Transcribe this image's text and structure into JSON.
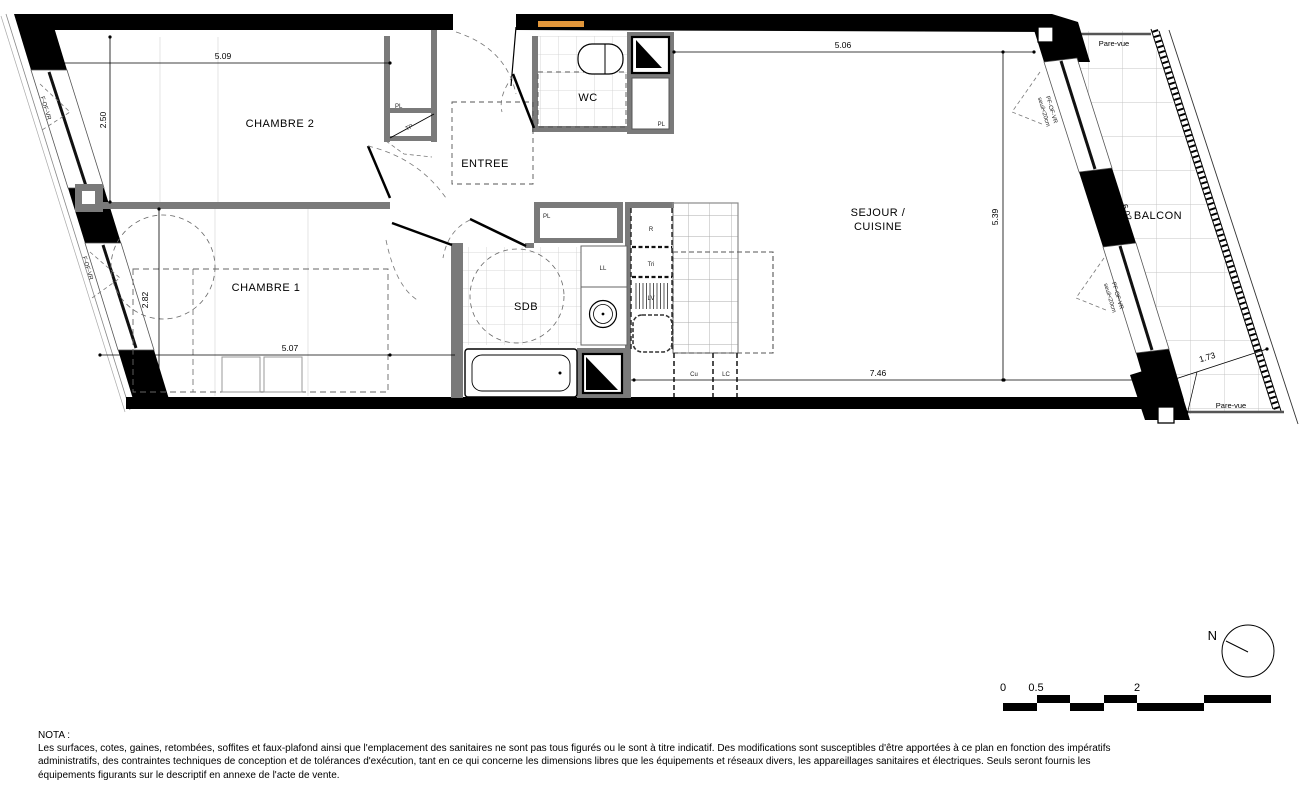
{
  "plan": {
    "rooms": {
      "chambre2": "CHAMBRE 2",
      "chambre1": "CHAMBRE 1",
      "entree": "ENTREE",
      "wc": "WC",
      "sdb": "SDB",
      "sejour_line1": "SEJOUR /",
      "sejour_line2": "CUISINE",
      "balcon": "BALCON"
    },
    "dimensions": {
      "ch2_w": "5.09",
      "ch2_h": "2.50",
      "ch1_h": "2.82",
      "ch1_w": "5.07",
      "sej_w": "5.06",
      "sej_h": "5.39",
      "sej_w2": "7.46",
      "balcon_l": "6.02",
      "balcon_w": "1.73"
    },
    "labels": {
      "pl": "PL",
      "tp": "TP",
      "ll": "LL",
      "r": "R",
      "tri": "Tri",
      "lv": "LV",
      "cu": "Cu",
      "lc": "LC",
      "pare_vue": "Pare-vue",
      "f_of_vr": "F-OF-VR",
      "pf_of_vr": "PF-OF-VR",
      "seuil": "seuil<20cm"
    }
  },
  "nota": {
    "title": "NOTA :",
    "lines": [
      "Les surfaces, cotes, gaines, retombées, soffites et faux-plafond ainsi que l'emplacement des sanitaires ne sont pas tous figurés ou le sont à titre indicatif. Des modifications sont susceptibles d'être apportées à ce plan en fonction des impératifs",
      "administratifs, des contraintes techniques de conception et de tolérances d'exécution, tant en ce qui concerne les dimensions libres que les équipements et réseaux divers, les appareillages sanitaires et électriques. Seuls seront fournis les",
      "équipements figurants sur le descriptif en annexe de l'acte de vente."
    ]
  },
  "scalebar": {
    "t0": "0",
    "t05": "0.5",
    "t2": "2"
  },
  "compass": {
    "north": "N"
  },
  "colors": {
    "wall": "#000000",
    "interior_wall": "#7a7a7a",
    "tile_line": "#c9c9c9",
    "dashed": "#555555",
    "accent_orange": "#e2973b"
  }
}
